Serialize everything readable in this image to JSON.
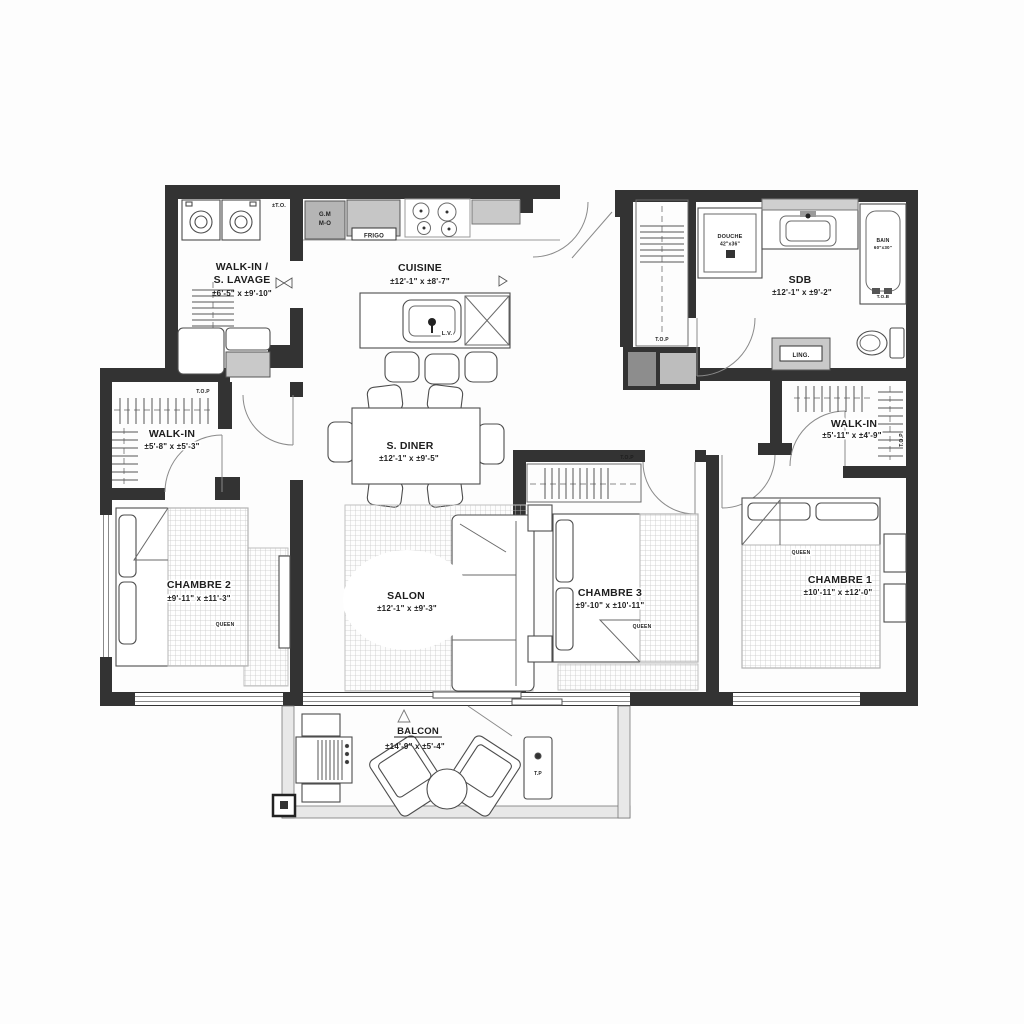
{
  "plan": {
    "rooms": {
      "walkin_lavage": {
        "name_line1": "WALK-IN /",
        "name_line2": "S. LAVAGE",
        "dims": "±6'-5\" x ±9'-10\""
      },
      "cuisine": {
        "name": "CUISINE",
        "dims": "±12'-1\" x ±8'-7\""
      },
      "sdb": {
        "name": "SDB",
        "dims": "±12'-1\" x ±9'-2\""
      },
      "walkin_left": {
        "name": "WALK-IN",
        "dims": "±5'-8\" x ±5'-3\""
      },
      "sdiner": {
        "name": "S. DINER",
        "dims": "±12'-1\" x ±9'-5\""
      },
      "chambre2": {
        "name": "CHAMBRE 2",
        "dims": "±9'-11\" x ±11'-3\""
      },
      "salon": {
        "name": "SALON",
        "dims": "±12'-1\" x ±9'-3\""
      },
      "chambre3": {
        "name": "CHAMBRE 3",
        "dims": "±9'-10\" x ±10'-11\""
      },
      "chambre1": {
        "name": "CHAMBRE 1",
        "dims": "±10'-11\" x ±12'-0\""
      },
      "walkin_right": {
        "name": "WALK-IN",
        "dims": "±5'-11\" x ±4'-9\""
      },
      "balcon": {
        "name": "BALCON",
        "dims": "±14'-9\" x ±5'-4\""
      }
    },
    "fixtures": {
      "gm": "G.M",
      "mo": "M-O",
      "frigo": "FRIGO",
      "lv": "L.V.",
      "douche": "DOUCHE",
      "douche_size": "42\"x36\"",
      "bain": "BAIN",
      "bain_size": "60\"x30\"",
      "tob": "T.O.B",
      "ling": "LING.",
      "top": "T.O.P",
      "to": "±T.O.",
      "queen": "QUEEN",
      "tp": "T.P"
    }
  }
}
